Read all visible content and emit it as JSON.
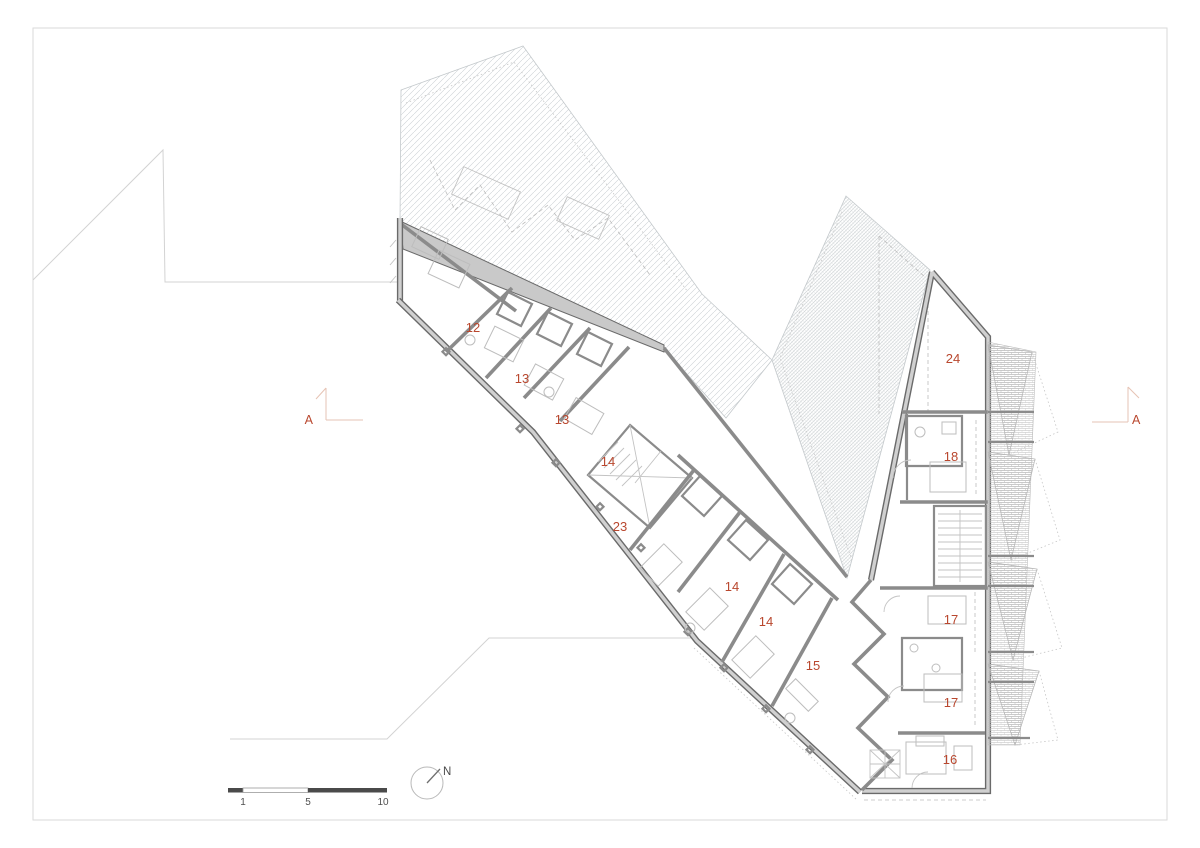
{
  "drawing": {
    "rooms": [
      {
        "label": "12",
        "x": 473,
        "y": 332
      },
      {
        "label": "13",
        "x": 522,
        "y": 383
      },
      {
        "label": "13",
        "x": 562,
        "y": 424
      },
      {
        "label": "14",
        "x": 608,
        "y": 466
      },
      {
        "label": "23",
        "x": 620,
        "y": 531
      },
      {
        "label": "14",
        "x": 732,
        "y": 591
      },
      {
        "label": "14",
        "x": 766,
        "y": 626
      },
      {
        "label": "15",
        "x": 813,
        "y": 670
      },
      {
        "label": "24",
        "x": 953,
        "y": 363
      },
      {
        "label": "18",
        "x": 951,
        "y": 461
      },
      {
        "label": "17",
        "x": 951,
        "y": 624
      },
      {
        "label": "17",
        "x": 951,
        "y": 707
      },
      {
        "label": "16",
        "x": 950,
        "y": 764
      }
    ],
    "section_markers": {
      "left": {
        "label": "A"
      },
      "right": {
        "label": "A"
      }
    },
    "scale_bar": {
      "labels": [
        "1",
        "5",
        "10"
      ]
    },
    "north_arrow": {
      "label": "N"
    },
    "colors": {
      "accent": "#b9472e",
      "wall_dark": "#6a6a6a",
      "wall_fill": "#cdcdcd",
      "wall_mid": "#8b8b8b",
      "hatch": "#c6cbce",
      "site_line": "#d3d3d3"
    }
  }
}
